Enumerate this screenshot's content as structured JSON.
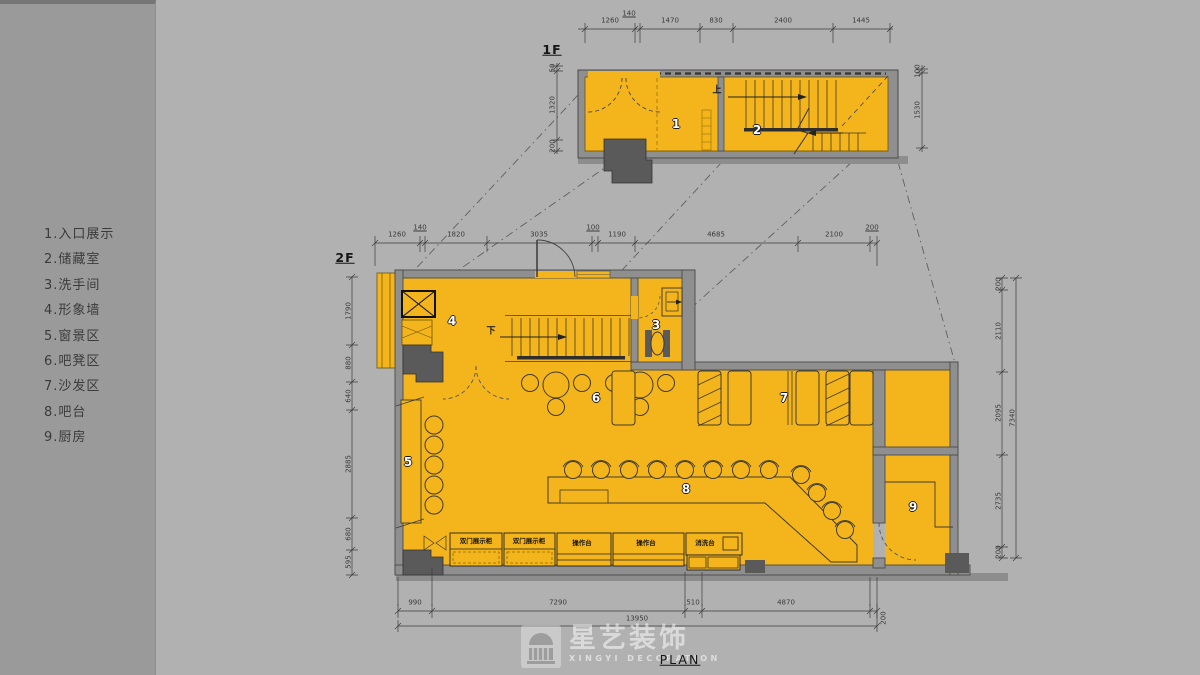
{
  "legend": {
    "items": [
      "1.入口展示",
      "2.储藏室",
      "3.洗手间",
      "4.形象墙",
      "5.窗景区",
      "6.吧凳区",
      "7.沙发区",
      "8.吧台",
      "9.厨房"
    ]
  },
  "plans": {
    "f1": {
      "label": "1F",
      "room_numbers": [
        "1",
        "2"
      ],
      "stair_label": "上",
      "dims_top": [
        "1260",
        "140",
        "1470",
        "830",
        "2400",
        "1445"
      ],
      "dims_left": [
        "50",
        "1320",
        "200"
      ],
      "dims_right": [
        "100",
        "1530"
      ]
    },
    "f2": {
      "label": "2F",
      "room_numbers": [
        "3",
        "4",
        "5",
        "6",
        "7",
        "8",
        "9"
      ],
      "stair_label": "下",
      "dims_top": [
        "1260",
        "140",
        "1820",
        "3035",
        "100",
        "1190",
        "4685",
        "2100",
        "200"
      ],
      "dims_left": [
        "1790",
        "880",
        "640",
        "2885",
        "680",
        "595"
      ],
      "dims_right": [
        "200",
        "2110",
        "2095",
        "2735",
        "200",
        "7340"
      ],
      "dims_bottom": [
        "990",
        "7290",
        "510",
        "4870",
        "200",
        "13950"
      ],
      "cabinets": [
        "双门展示柜",
        "双门展示柜",
        "操作台",
        "操作台",
        "消洗台"
      ]
    }
  },
  "footer": {
    "plan_label": "PLAN"
  },
  "logo": {
    "name": "星艺装饰",
    "subtitle": "XINGYI DECORATION"
  },
  "colors": {
    "floor": "#F4B41C",
    "wall": "#8F8F8F",
    "background": "#B1B1B1",
    "sidebar": "#9A9A9A"
  }
}
